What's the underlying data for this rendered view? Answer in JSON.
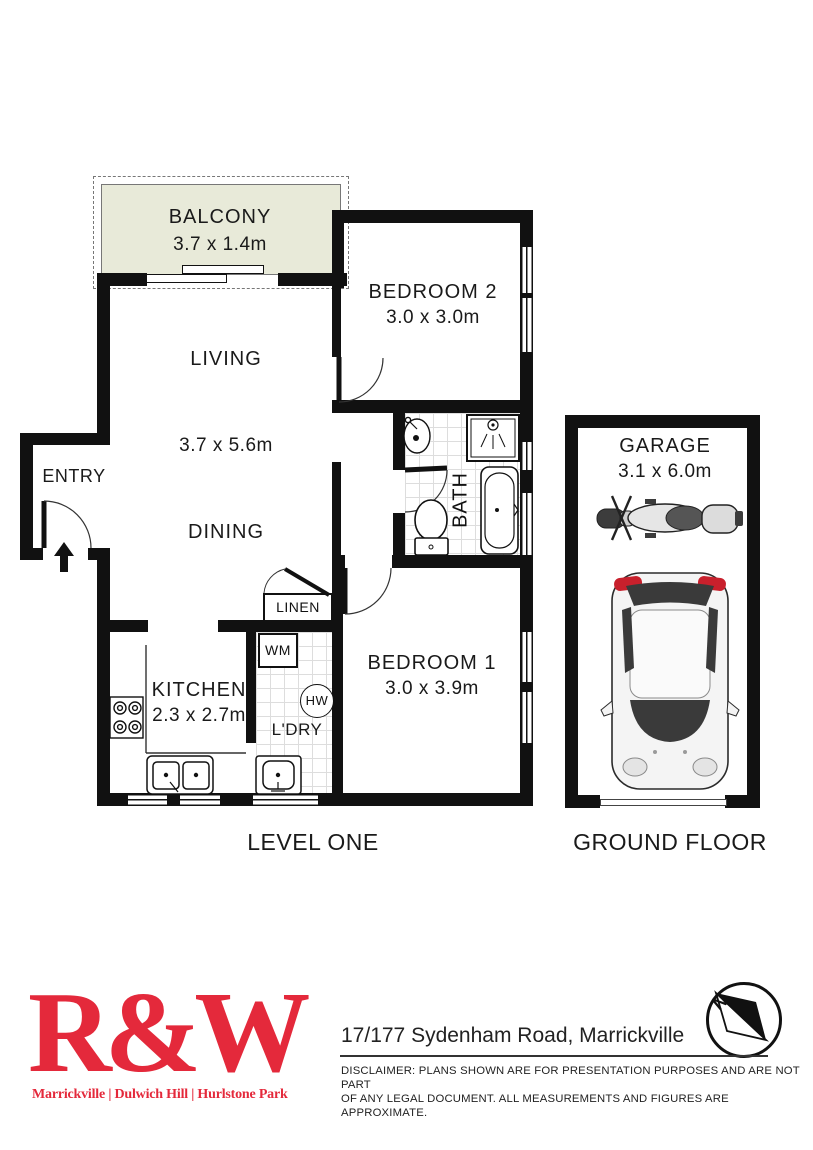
{
  "plan": {
    "balcony": {
      "name": "BALCONY",
      "dims": "3.7 x 1.4m"
    },
    "living": {
      "name": "LIVING",
      "dims": "3.7 x 5.6m"
    },
    "dining": {
      "name": "DINING"
    },
    "entry": {
      "name": "ENTRY"
    },
    "bedroom2": {
      "name": "BEDROOM 2",
      "dims": "3.0 x 3.0m"
    },
    "bath": {
      "name": "BATH"
    },
    "bedroom1": {
      "name": "BEDROOM 1",
      "dims": "3.0 x 3.9m"
    },
    "kitchen": {
      "name": "KITCHEN",
      "dims": "2.3 x 2.7m"
    },
    "linen": {
      "name": "LINEN"
    },
    "laundry": {
      "name": "L'DRY",
      "washing_machine": "WM",
      "hot_water": "HW"
    },
    "garage": {
      "name": "GARAGE",
      "dims": "3.1 x 6.0m"
    },
    "level_one_label": "LEVEL ONE",
    "ground_floor_label": "GROUND FLOOR",
    "north_label": "N",
    "balcony_fill": "#e8ead9",
    "wall_color": "#111111"
  },
  "footer": {
    "logo_text": "R&W",
    "logo_tagline": "Marrickville | Dulwich Hill | Hurlstone Park",
    "brand_color": "#e4293b",
    "address": "17/177 Sydenham Road, Marrickville",
    "disclaimer_line1": "DISCLAIMER:  PLANS SHOWN ARE FOR PRESENTATION PURPOSES AND ARE NOT PART",
    "disclaimer_line2": "OF ANY LEGAL DOCUMENT. ALL MEASUREMENTS AND FIGURES ARE APPROXIMATE."
  }
}
